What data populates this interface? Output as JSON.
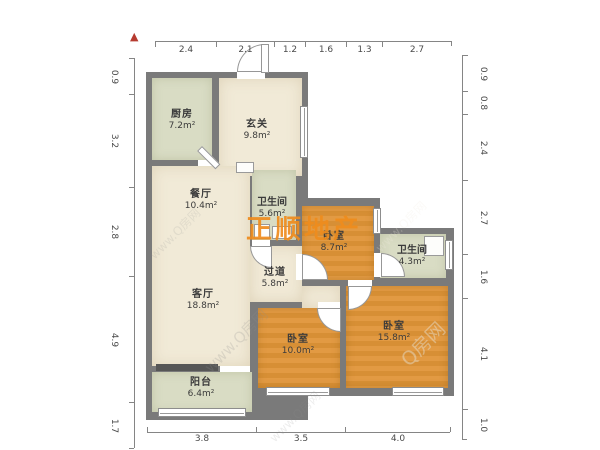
{
  "north_indicator": {
    "symbol": "▲"
  },
  "rulers": {
    "top": {
      "values": [
        "2.4",
        "2.1",
        "1.2",
        "1.6",
        "1.3",
        "2.7"
      ]
    },
    "bottom": {
      "values": [
        "3.8",
        "3.5",
        "4.0"
      ]
    },
    "left": {
      "values": [
        "0.9",
        "3.2",
        "2.8",
        "4.9",
        "1.7"
      ]
    },
    "right": {
      "values": [
        "0.9",
        "0.8",
        "2.4",
        "2.7",
        "1.6",
        "4.1",
        "1.0"
      ]
    }
  },
  "rooms": [
    {
      "name": "厨房",
      "area": "7.2m²"
    },
    {
      "name": "玄关",
      "area": "9.8m²"
    },
    {
      "name": "餐厅",
      "area": "10.4m²"
    },
    {
      "name": "卫生间",
      "area": "5.6m²"
    },
    {
      "name": "卧室",
      "area": "8.7m²"
    },
    {
      "name": "卫生间",
      "area": "4.3m²"
    },
    {
      "name": "过道",
      "area": "5.8m²"
    },
    {
      "name": "客厅",
      "area": "18.8m²"
    },
    {
      "name": "卧室",
      "area": "10.0m²"
    },
    {
      "name": "卧室",
      "area": "15.8m²"
    },
    {
      "name": "阳台",
      "area": "6.4m²"
    }
  ],
  "watermarks": {
    "brand": "正顺地产",
    "portal": "Q房网",
    "portal_url": "www.Q房网"
  },
  "colors": {
    "wall": "#7a7a7a",
    "floor_cream": "#f1ead7",
    "floor_green": "#d9dcc4",
    "floor_orange": "#e0993f",
    "brand_orange": "#ef8c1d",
    "north_red": "#b63b30"
  }
}
